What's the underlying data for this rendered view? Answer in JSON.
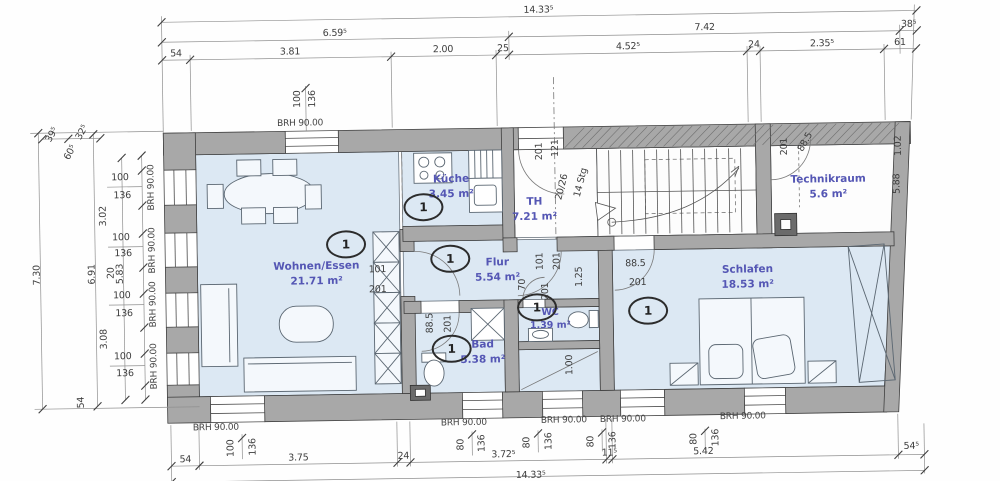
{
  "marker": "1",
  "brh": "BRH 90.00",
  "rooms": [
    {
      "name": "Wohnen/Essen",
      "area": "21.71 m²"
    },
    {
      "name": "Küche",
      "area": "3.45 m²"
    },
    {
      "name": "Flur",
      "area": "5.54 m²"
    },
    {
      "name": "Bad",
      "area": "5.38 m²"
    },
    {
      "name": "WC",
      "area": "1.39 m²"
    },
    {
      "name": "Schlafen",
      "area": "18.53 m²"
    },
    {
      "name": "TH",
      "area": "7.21 m²"
    },
    {
      "name": "Technikraum",
      "area": "5.6 m²"
    }
  ],
  "dims_top": {
    "overall": "14.33⁵",
    "mid": [
      "6.59⁵",
      "7.42",
      "38⁵"
    ],
    "detail": [
      "54",
      "3.81",
      "2.00",
      "25",
      "4.52⁵",
      "24",
      "2.35⁵",
      "61"
    ]
  },
  "dims_bottom": {
    "detail": [
      "54",
      "3.75",
      "24",
      "3.72⁵",
      "11⁵",
      "5.42",
      "54⁵"
    ],
    "overall": "14.33⁵"
  },
  "dims_left": {
    "overall": "7.30",
    "mid": "6.91",
    "inner": "5.83",
    "small": [
      "39⁵",
      "32⁵",
      "60⁵"
    ],
    "chain": [
      "100",
      "136",
      "3.02",
      "100",
      "136",
      "20",
      "100",
      "136",
      "3.08",
      "100",
      "136",
      "54"
    ]
  },
  "dims_right": [
    "1.02",
    "5.88"
  ],
  "window_dims": {
    "top": [
      "100",
      "136"
    ],
    "bottom": [
      [
        "100",
        "136"
      ],
      [
        "80",
        "136"
      ],
      [
        "80",
        "136"
      ],
      [
        "80",
        "136"
      ],
      [
        "80",
        "136"
      ]
    ]
  },
  "door_dims": {
    "living": [
      "101",
      "201"
    ],
    "flur": [
      "101",
      "201",
      "70",
      "201",
      "1.25"
    ],
    "schlafen": [
      "88.5",
      "201"
    ],
    "bad": [
      "88.5",
      "201"
    ],
    "wc": "1.00",
    "technik": [
      "201",
      "88.5"
    ]
  },
  "stair_labels": [
    "201",
    "121",
    "20/26",
    "14 Stg"
  ]
}
